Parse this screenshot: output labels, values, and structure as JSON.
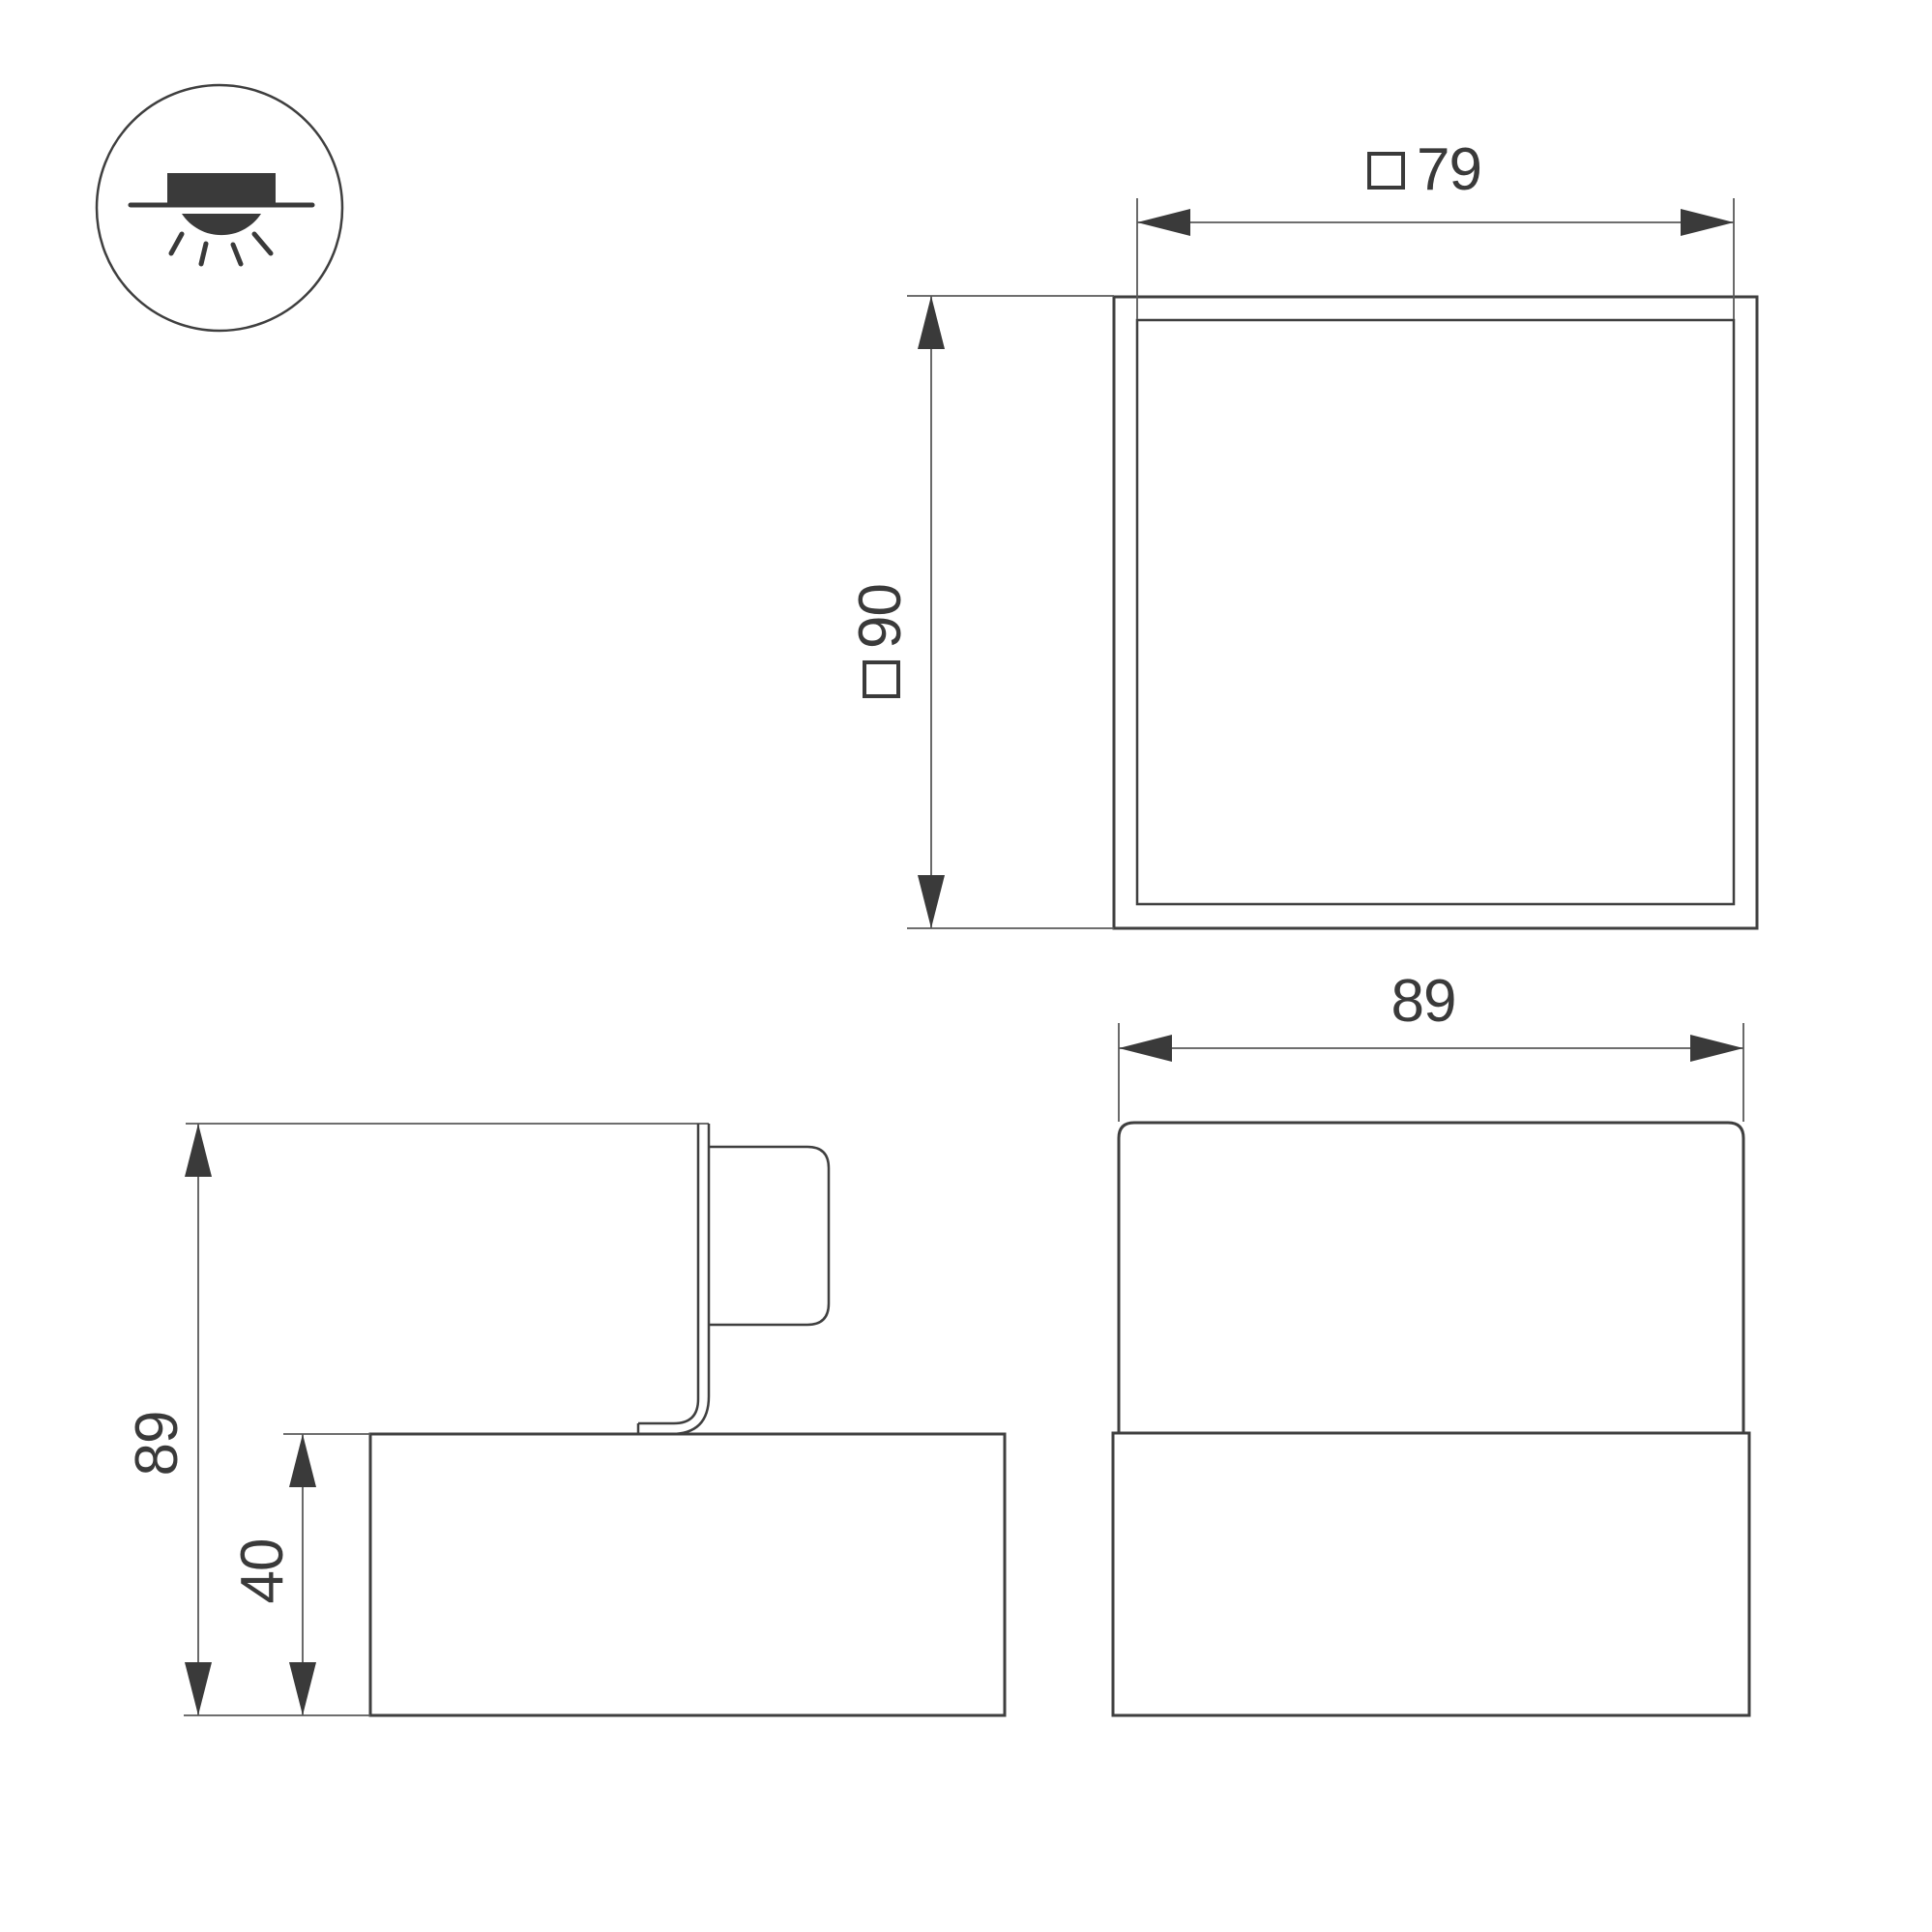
{
  "page": {
    "background": "#ffffff",
    "kind": "luminaire dimension drawing"
  },
  "colors": {
    "background": "#ffffff",
    "line": "#3f3f3f",
    "thin_line": "#5a5a5a",
    "text": "#3a3a3a",
    "fill": "#3a3a3a"
  },
  "icon": {
    "name": "recessed-downlight-icon",
    "meaning": "recessed ceiling mounting with downward light"
  },
  "views": {
    "top": {
      "width_dim": {
        "square_symbol": true,
        "value": "79"
      },
      "height_dim": {
        "square_symbol": true,
        "value": "90"
      }
    },
    "side": {
      "height_dim": {
        "value": "89"
      },
      "base_height_dim": {
        "value": "40"
      }
    },
    "front": {
      "width_dim": {
        "value": "89"
      }
    }
  }
}
